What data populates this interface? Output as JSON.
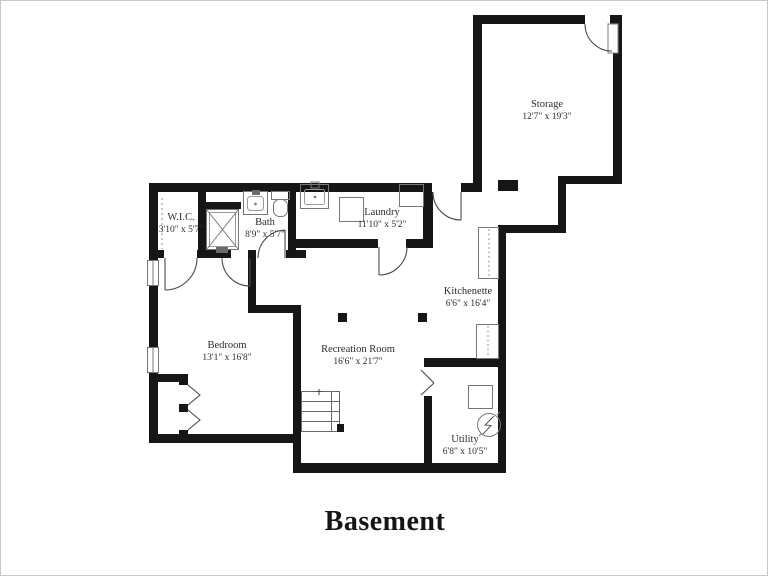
{
  "title": "Basement",
  "rooms": [
    {
      "id": "storage",
      "name": "Storage",
      "dims": "12'7\" x 19'3\""
    },
    {
      "id": "wic",
      "name": "W.I.C.",
      "dims": "3'10\" x 5'7\""
    },
    {
      "id": "bath",
      "name": "Bath",
      "dims": "8'9\" x 5'7\""
    },
    {
      "id": "laundry",
      "name": "Laundry",
      "dims": "11'10\" x 5'2\""
    },
    {
      "id": "kitchenette",
      "name": "Kitchenette",
      "dims": "6'6\" x 16'4\""
    },
    {
      "id": "bedroom",
      "name": "Bedroom",
      "dims": "13'1\" x 16'8\""
    },
    {
      "id": "recreation",
      "name": "Recreation Room",
      "dims": "16'6\" x 21'7\""
    },
    {
      "id": "utility",
      "name": "Utility",
      "dims": "6'8\" x 10'5\""
    }
  ],
  "colors": {
    "wall": "#161616",
    "background": "#ffffff",
    "label_text": "#2d2d2d",
    "fixture_line": "#777777",
    "door_line": "#4a4a4a",
    "canvas_border": "#c9c9c9"
  }
}
